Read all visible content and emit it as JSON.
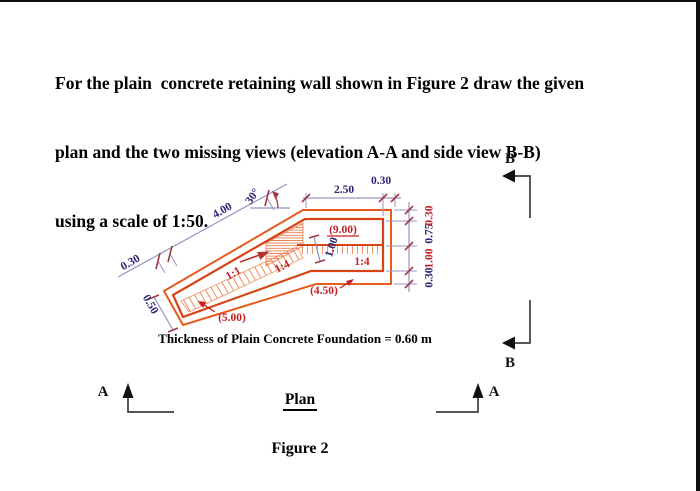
{
  "title": {
    "line1": "For the plain  concrete retaining wall shown in Figure 2 draw the given",
    "line2": "plan and the two missing views (elevation A-A and side view B-B)",
    "line3": "using a scale of 1:50."
  },
  "note": "Thickness of Plain Concrete Foundation = 0.60 m",
  "view_label": "Plan",
  "caption": "Figure 2",
  "sections": {
    "a": "A",
    "b": "B"
  },
  "dims": {
    "diag_offset": "0.30",
    "diag_length": "4.00",
    "angle": "30°",
    "top_width": "2.50",
    "top_edge": "0.30",
    "tip_width": "0.50",
    "stem_width": "1.00",
    "right_stack_bottom_to_top": [
      "0.30",
      "1.00",
      "0.75",
      "0.30"
    ]
  },
  "labels": {
    "inner_length": "(9.00)",
    "slope_mid": "1:4",
    "slope_diag": "1:4",
    "slope_heel": "1:1",
    "bottom_length": "(4.50)",
    "tip_length": "(5.00)"
  },
  "colors": {
    "foundation_outline": "#e65c1f",
    "wall_outline": "#d64415",
    "hatch": "#ef8f62",
    "dimension_line": "#9a93c2",
    "tick": "#a03a42",
    "dim_text": "#2c2377",
    "label_text": "#c32026",
    "black": "#111111"
  }
}
